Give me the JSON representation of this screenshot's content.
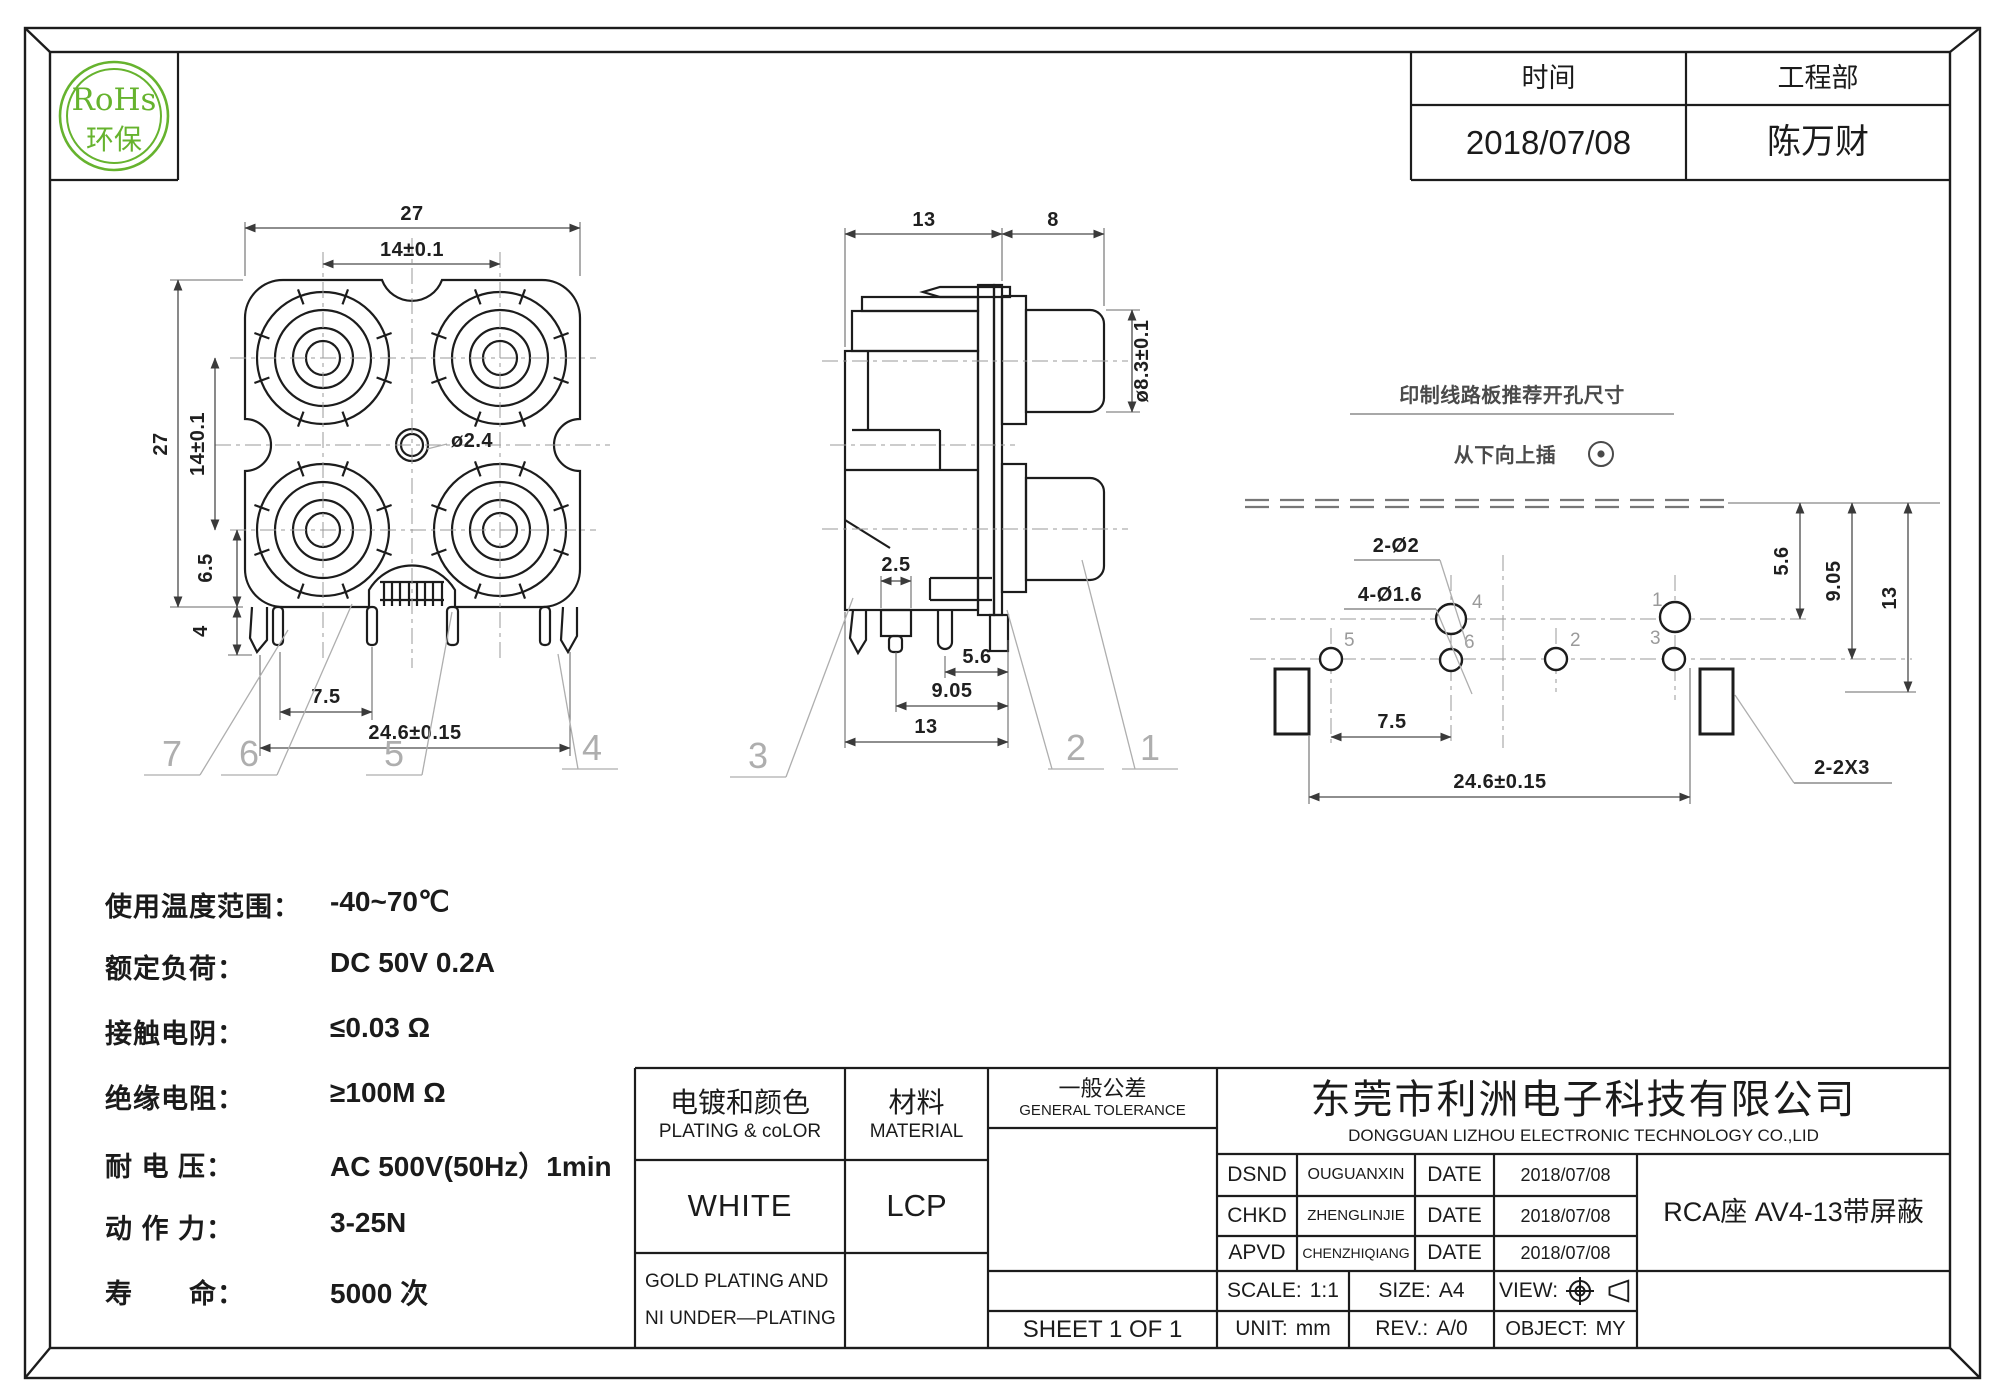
{
  "logo": {
    "line1": "RoHs",
    "line2": "环保"
  },
  "header_table": {
    "time_label": "时间",
    "dept_label": "工程部",
    "time_value": "2018/07/08",
    "dept_value": "陈万财"
  },
  "front_view": {
    "dim_width": "27",
    "dim_pitch_h": "14±0.1",
    "dim_height": "27",
    "dim_pitch_v": "14±0.1",
    "dim_6_5": "6.5",
    "dim_4": "4",
    "dim_center_hole": "ø2.4",
    "dim_pin_pitch": "7.5",
    "dim_pin_span": "24.6±0.15",
    "callout_7": "7",
    "callout_6": "6",
    "callout_5": "5",
    "callout_4": "4"
  },
  "side_view": {
    "dim_body": "13",
    "dim_barrel": "8",
    "dim_barrel_dia": "ø8.3±0.1",
    "dim_2_5": "2.5",
    "dim_5_6": "5.6",
    "dim_9_05": "9.05",
    "dim_13": "13",
    "callout_3": "3",
    "callout_2": "2",
    "callout_1": "1"
  },
  "pcb_view": {
    "title": "印制线路板推荐开孔尺寸",
    "insert_note": "从下向上插",
    "dim_big_holes": "2-Ø2",
    "dim_small_holes": "4-Ø1.6",
    "dim_5_6": "5.6",
    "dim_9_05": "9.05",
    "dim_13": "13",
    "dim_7_5": "7.5",
    "dim_span": "24.6±0.15",
    "dim_slots": "2-2X3",
    "pin4": "4",
    "pin1": "1",
    "pin5": "5",
    "pin6": "6",
    "pin2": "2",
    "pin3": "3"
  },
  "specs": {
    "rows": [
      {
        "label": "使用温度范围：",
        "value": "-40~70℃"
      },
      {
        "label": "额定负荷：",
        "value": "DC 50V 0.2A"
      },
      {
        "label": "接触电阴：",
        "value": "≤0.03 Ω"
      },
      {
        "label": "绝缘电阻：",
        "value": "≥100M Ω"
      },
      {
        "label": "耐 电 压：",
        "value": "AC 500V(50Hz）1min"
      },
      {
        "label": "动 作 力：",
        "value": "3-25N"
      },
      {
        "label": "寿　　命：",
        "value": "5000 次"
      }
    ]
  },
  "title_block": {
    "plating_cn": "电镀和颜色",
    "plating_en": "PLATING & coLOR",
    "material_cn": "材料",
    "material_en": "MATERIAL",
    "tolerance_cn": "一般公差",
    "tolerance_en": "GENERAL TOLERANCE",
    "plating_value": "WHITE",
    "material_value": "LCP",
    "plating_note1": "GOLD PLATING AND",
    "plating_note2": "NI UNDER—PLATING",
    "sheet": "SHEET 1 OF 1",
    "company_cn": "东莞市利洲电子科技有限公司",
    "company_en": "DONGGUAN LIZHOU ELECTRONIC TECHNOLOGY CO.,LID",
    "approvals": [
      {
        "role": "DSND",
        "name": "OUGUANXIN",
        "date_label": "DATE",
        "date": "2018/07/08"
      },
      {
        "role": "CHKD",
        "name": "ZHENGLINJIE",
        "date_label": "DATE",
        "date": "2018/07/08"
      },
      {
        "role": "APVD",
        "name": "CHENZHIQIANG",
        "date_label": "DATE",
        "date": "2018/07/08"
      }
    ],
    "part_name": "RCA座 AV4-13带屏蔽",
    "scale_label": "SCALE:",
    "scale_value": "1:1",
    "size_label": "SIZE:",
    "size_value": "A4",
    "view_label": "VIEW:",
    "unit_label": "UNIT:",
    "unit_value": "mm",
    "rev_label": "REV.:",
    "rev_value": "A/0",
    "object_label": "OBJECT:",
    "object_value": "MY"
  }
}
